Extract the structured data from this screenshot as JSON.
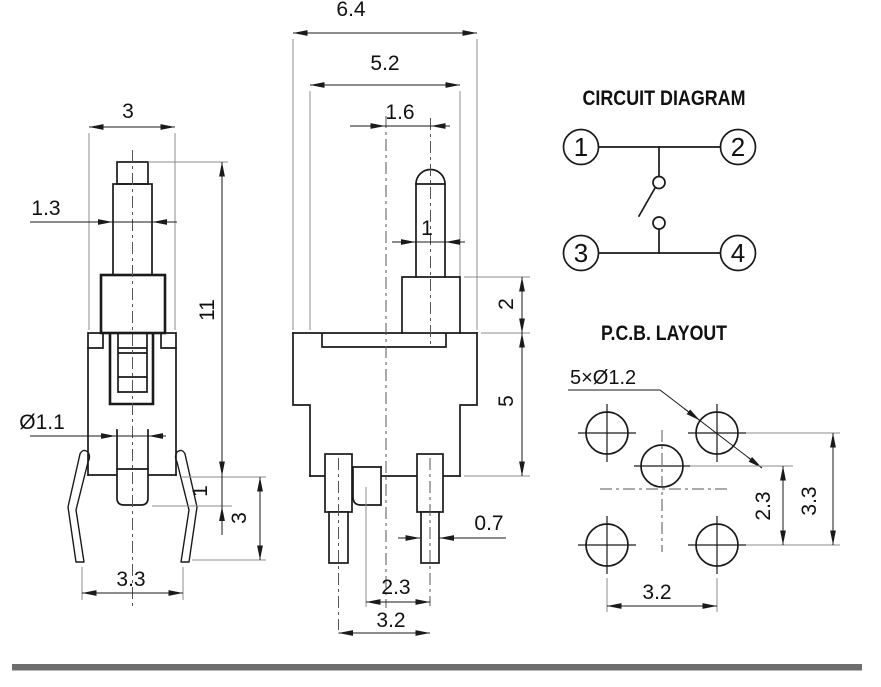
{
  "front_view": {
    "dims": {
      "top_width": "3",
      "shaft_width": "1.3",
      "total_height": "11",
      "stem_diameter": "Ø1.1",
      "stem_length": "1",
      "leg_height": "3",
      "feet_span": "3.3"
    }
  },
  "side_view": {
    "dims": {
      "flange_width": "6.4",
      "body_width": "5.2",
      "plunger_offset": "1.6",
      "plunger_width": "1",
      "neck_height": "2",
      "body_height": "5",
      "pin_width": "0.7",
      "stem_to_pin": "2.3",
      "pin_pitch": "3.2"
    }
  },
  "circuit_diagram": {
    "title": "CIRCUIT DIAGRAM",
    "terminals": [
      "1",
      "2",
      "3",
      "4"
    ]
  },
  "pcb_layout": {
    "title": "P.C.B. LAYOUT",
    "holes_note": "5×Ø1.2",
    "dims": {
      "center_to_row": "2.3",
      "row_spacing": "3.3",
      "column_spacing": "3.2"
    }
  },
  "colors": {
    "line": "#1a1a1a",
    "extension_line": "#8c8c8c",
    "divider_bar": "#6e6e6e",
    "background": "#ffffff"
  }
}
